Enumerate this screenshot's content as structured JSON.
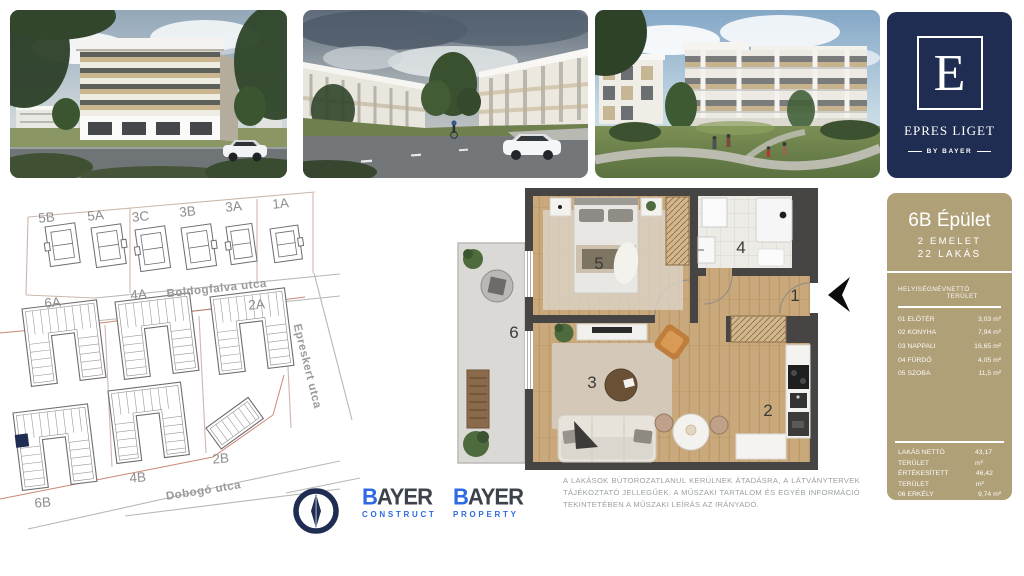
{
  "brand": {
    "logo_letter": "E",
    "logo_title": "EPRES LIGET",
    "logo_by": "BY BAYER",
    "navy": "#1f2d52",
    "tan": "#b0a078"
  },
  "unit_panel": {
    "title": "6B Épület",
    "floors": "2 EMELET",
    "units": "22 LAKÁS",
    "table": {
      "header_name": "HELYISÉGNÉV",
      "header_area": "NETTÓ TERÜLET",
      "rows": [
        {
          "name": "01 ELŐTÉR",
          "area": "3,03 m²"
        },
        {
          "name": "02 KONYHA",
          "area": "7,94 m²"
        },
        {
          "name": "03 NAPPALI",
          "area": "16,65 m²"
        },
        {
          "name": "04 FÜRDŐ",
          "area": "4,05 m²"
        },
        {
          "name": "05 SZOBA",
          "area": "11,5 m²"
        }
      ]
    },
    "summary": [
      {
        "name": "LAKÁS NETTÓ TERÜLET",
        "area": "43,17 m²"
      },
      {
        "name": "ÉRTÉKESÍTETT TERÜLET",
        "area": "46,42 m²"
      },
      {
        "name": "06 ERKÉLY",
        "area": "9,74 m²"
      }
    ]
  },
  "site_map": {
    "streets": [
      "Boldogfalva utca",
      "Epreskert utca",
      "Dobogó utca"
    ],
    "buildings": [
      "5B",
      "5A",
      "3C",
      "3B",
      "3A",
      "1A",
      "6A",
      "4A",
      "2A",
      "6B",
      "4B",
      "2B"
    ],
    "highlighted_building": "6B",
    "highlight_color": "#1f2d52"
  },
  "floorplan": {
    "rooms": [
      "1",
      "2",
      "3",
      "4",
      "5",
      "6"
    ]
  },
  "footer": {
    "construct": {
      "initial": "B",
      "rest": "AYER",
      "division": "CONSTRUCT"
    },
    "property": {
      "initial": "B",
      "rest": "AYER",
      "division": "PROPERTY"
    },
    "blue": "#2d6ae3",
    "disclaimer": "A LAKÁSOK BÚTOROZATLANUL KERÜLNEK ÁTADÁSRA, A LÁTVÁNYTERVEK TÁJÉKOZTATÓ JELLEGŰEK. A MŰSZAKI TARTALOM ÉS EGYÉB INFORMÁCIÓ TEKINTETÉBEN A MŰSZAKI LEÍRÁS AZ IRÁNYADÓ."
  }
}
